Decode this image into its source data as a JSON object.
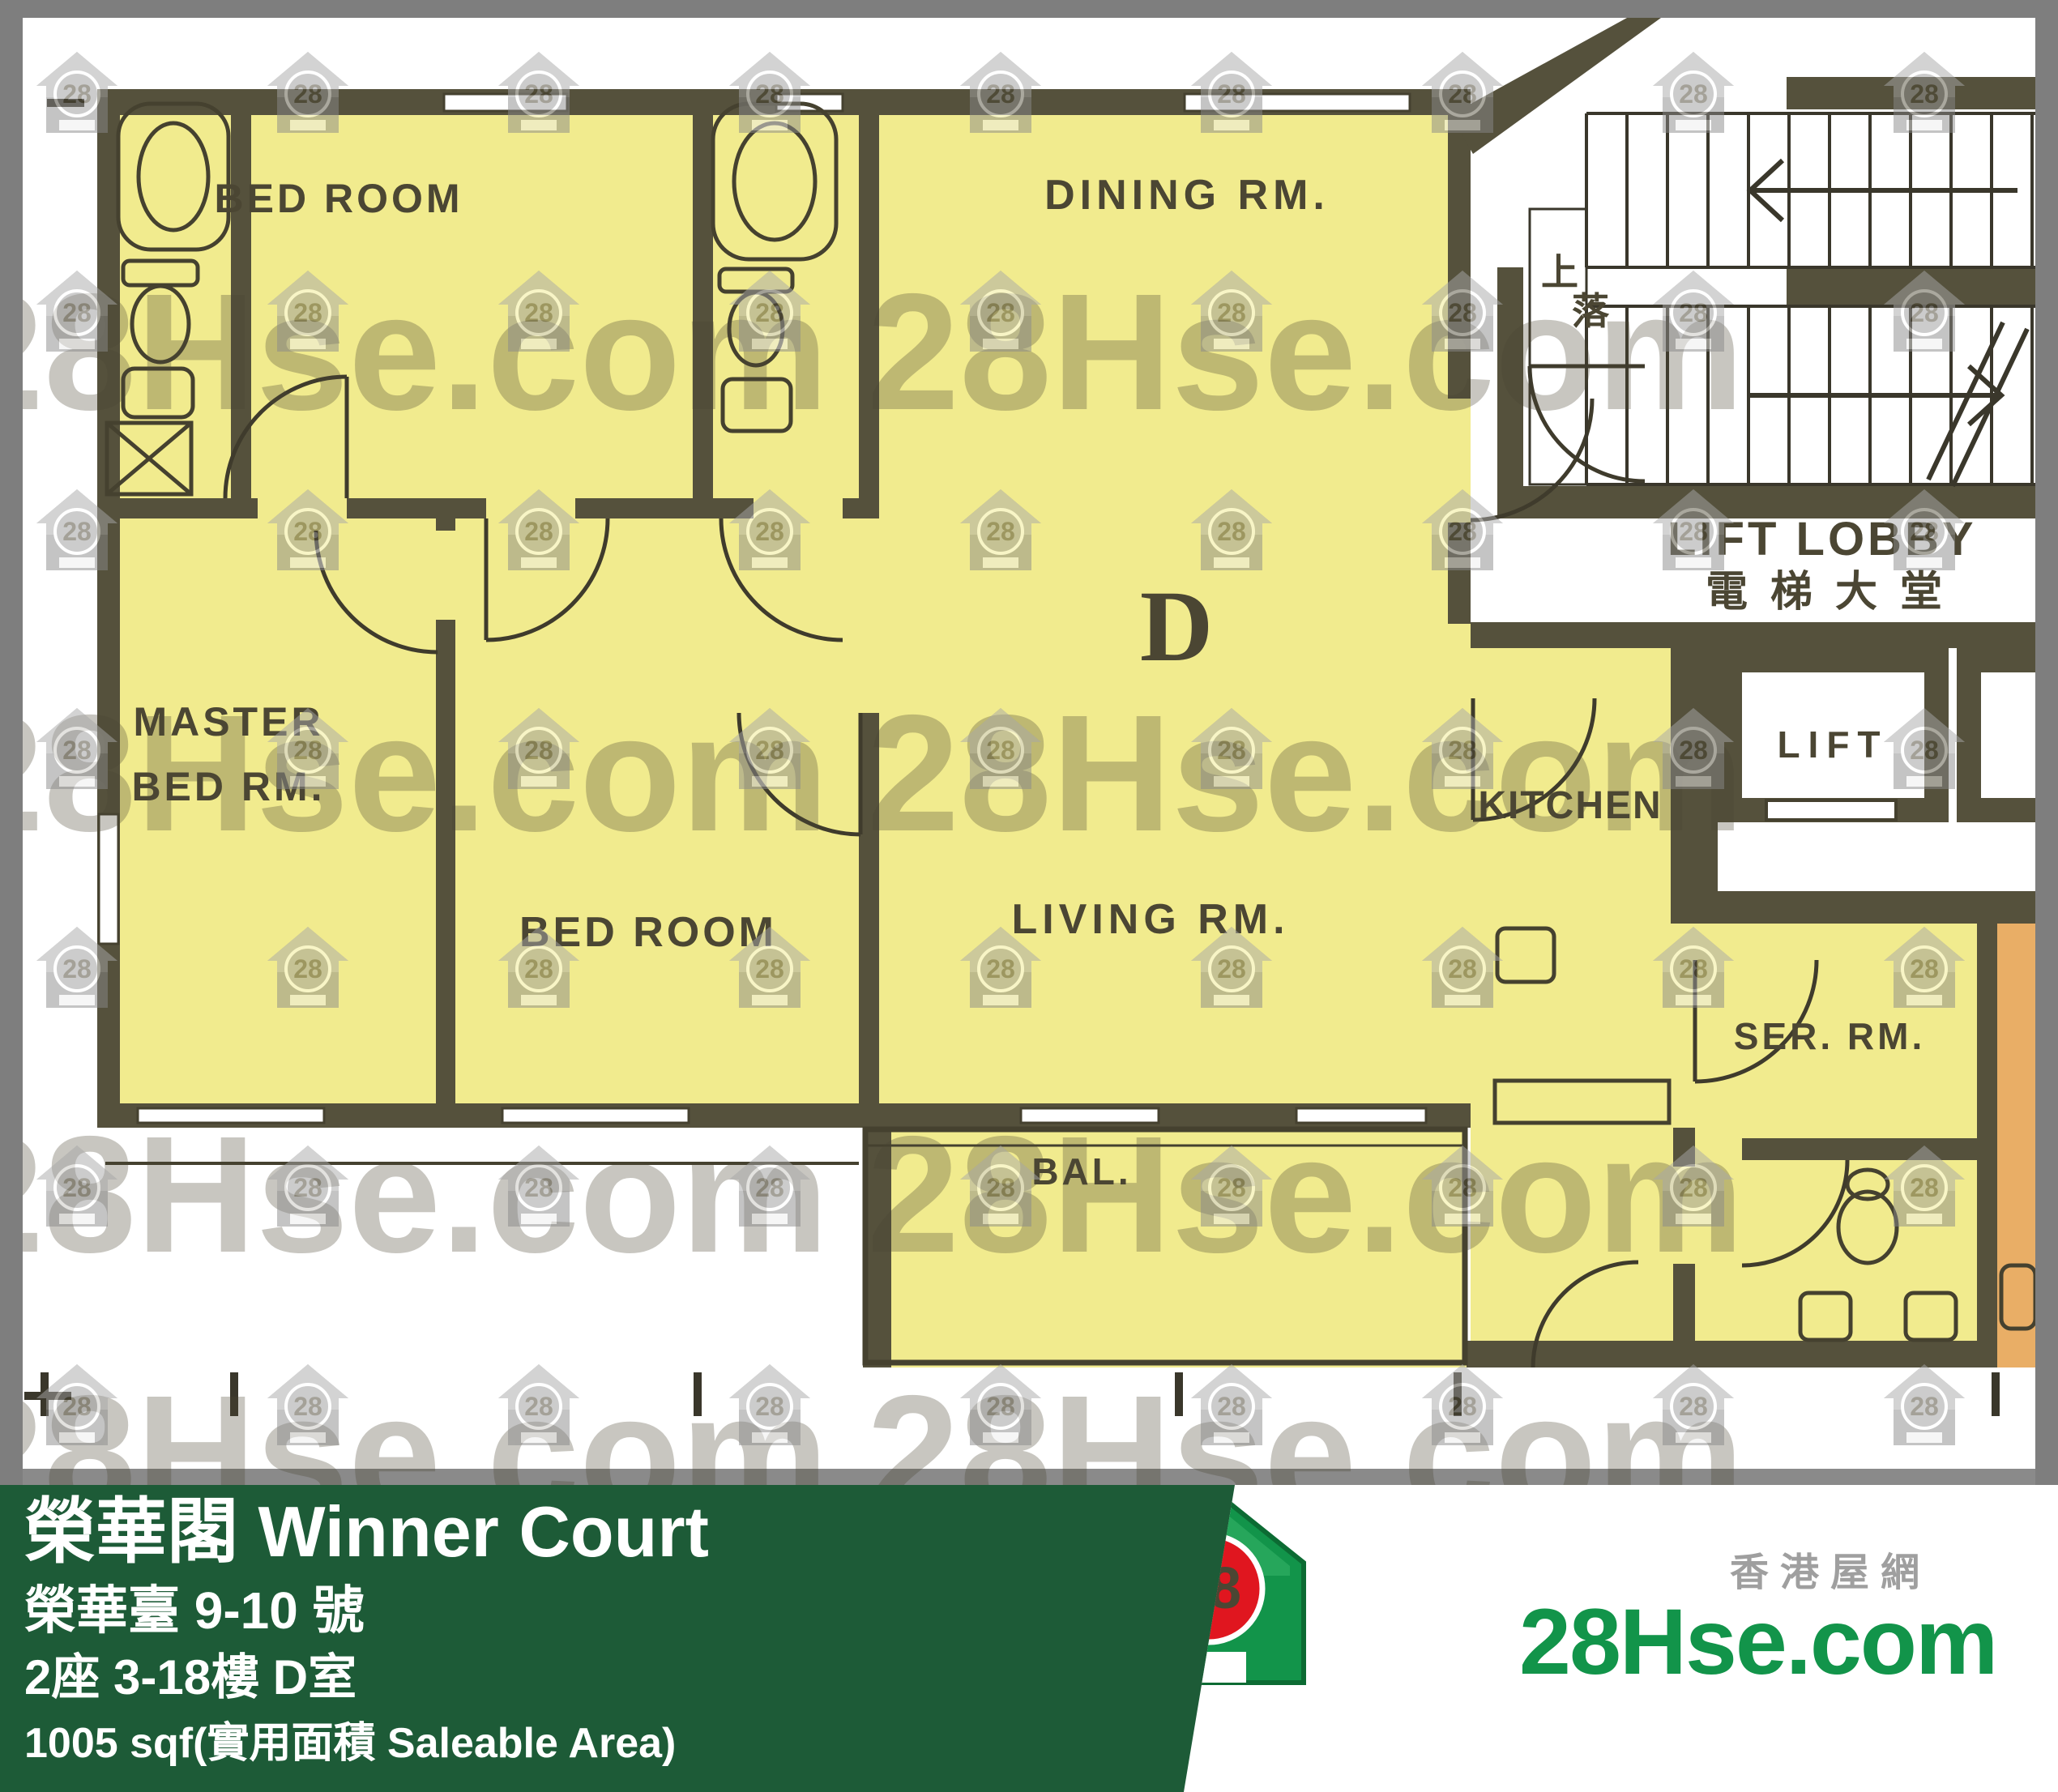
{
  "plan": {
    "labels": {
      "bedroom1": "BED ROOM",
      "dining": "DINING RM.",
      "master_line1": "MASTER",
      "master_line2": "BED RM.",
      "bedroom2": "BED ROOM",
      "living": "LIVING RM.",
      "kitchen": "KITCHEN",
      "balcony": "BAL.",
      "service_room": "SER. RM.",
      "lift_lobby_en": "LIFT LOBBY",
      "lift_lobby_cn": "電梯大堂",
      "lift": "LIFT",
      "stairs_up": "上",
      "stairs_down": "落",
      "unit_marker": "D"
    }
  },
  "banner": {
    "estate_name": "榮華閣 Winner Court",
    "address": "榮華臺 9-10 號",
    "unit_info": "2座 3-18樓 D室",
    "area_info": "1005 sqf(實用面積 Saleable Area)"
  },
  "logo": {
    "site_name_cn": "香港屋網",
    "brand": "28Hse.com",
    "badge": "28"
  },
  "watermark": {
    "brand": "28Hse.com",
    "badge": "28"
  },
  "colors": {
    "banner_green": "#1d5b37",
    "room_yellow": "#f1eb8e",
    "adjacent_orange": "#e9ae66",
    "wall": "#55513c",
    "frame_gray": "#7e7e7e",
    "logo_green": "#12944a",
    "logo_red": "#e0161f"
  }
}
